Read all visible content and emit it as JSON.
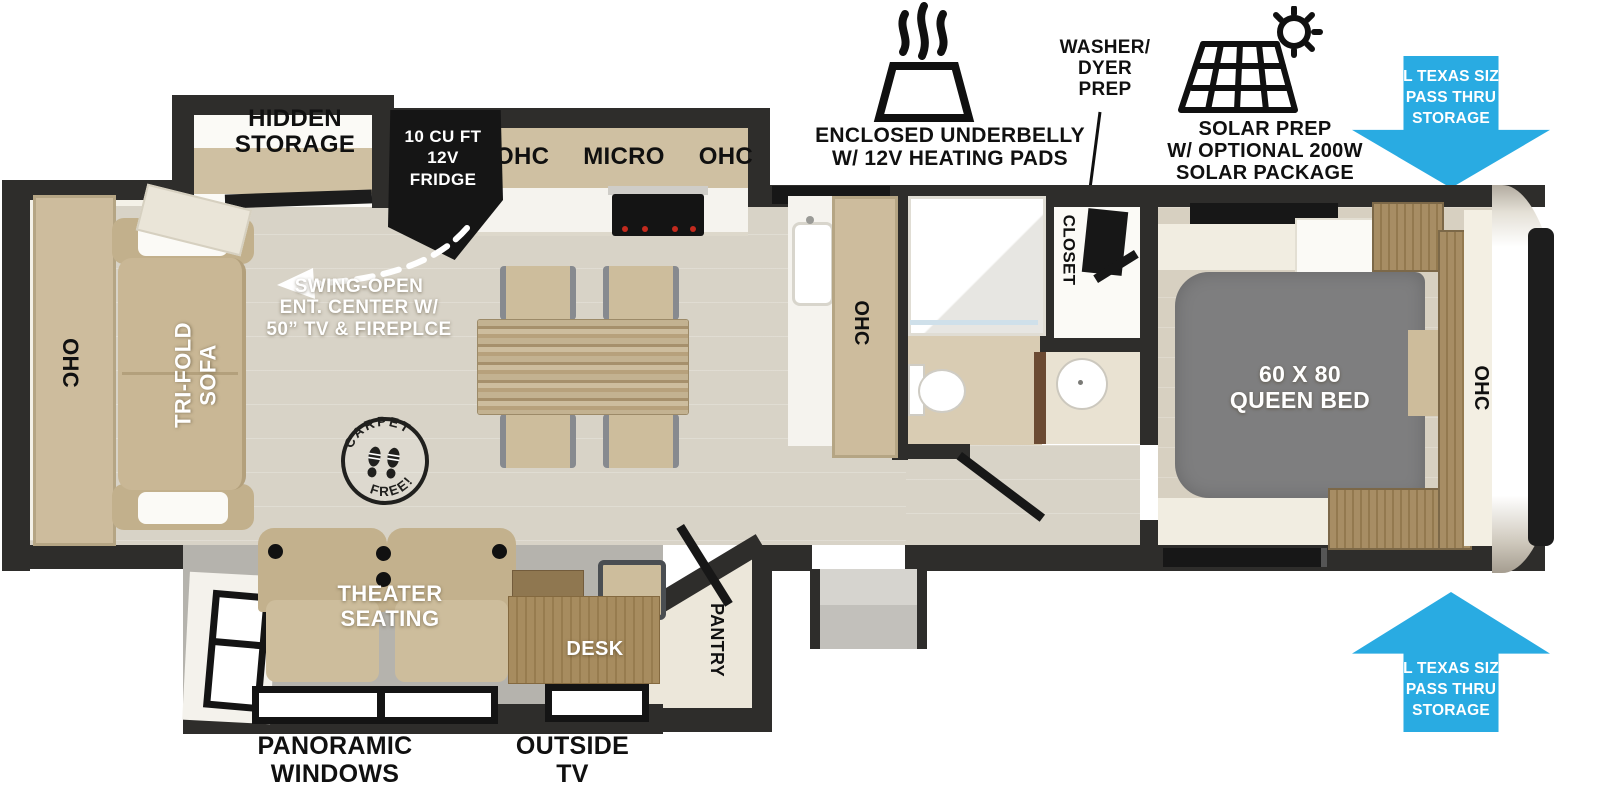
{
  "callouts": {
    "underbelly": {
      "icon": "heating-pad-icon",
      "lines": [
        "ENCLOSED UNDERBELLY",
        "W/ 12V HEATING PADS"
      ]
    },
    "washer_dryer": {
      "lines": [
        "WASHER/",
        "DYER",
        "PREP"
      ]
    },
    "solar": {
      "icon": "solar-panel-sun-icon",
      "lines": [
        "SOLAR PREP",
        "W/ OPTIONAL 200W",
        "SOLAR PACKAGE"
      ]
    },
    "pass_thru_top": {
      "icon": "blue-arrow-down-icon",
      "lines": [
        "XL TEXAS SIZE",
        "PASS THRU",
        "STORAGE"
      ]
    },
    "pass_thru_bottom": {
      "icon": "blue-arrow-up-icon",
      "lines": [
        "XL TEXAS SIZE",
        "PASS THRU",
        "STORAGE"
      ]
    }
  },
  "interior": {
    "hidden_storage": [
      "HIDDEN",
      "STORAGE"
    ],
    "fridge": [
      "10 CU FT",
      "12V",
      "FRIDGE"
    ],
    "kitchen_overhead": [
      "OHC",
      "MICRO",
      "OHC"
    ],
    "ent_center": [
      "SWING-OPEN",
      "ENT. CENTER W/",
      "50” TV & FIREPLCE"
    ],
    "carpet_stamp": {
      "top": "CARPET",
      "bottom": "FREE!"
    },
    "ohc_rear": "OHC",
    "sofa": [
      "TRI-FOLD",
      "SOFA"
    ],
    "ohc_kitchen": "OHC",
    "closet": "CLOSET",
    "queen_bed": [
      "60 X 80",
      "QUEEN BED"
    ],
    "ohc_bedroom": "OHC",
    "theater_seating": [
      "THEATER",
      "SEATING"
    ],
    "desk": "DESK",
    "pantry": "PANTRY"
  },
  "exterior_labels": {
    "panoramic_windows": [
      "PANORAMIC",
      "WINDOWS"
    ],
    "outside_tv": [
      "OUTSIDE",
      "TV"
    ]
  },
  "colors": {
    "accent_blue": "#29ABE2",
    "wall_dark": "#2E2D2B",
    "cabinet_tan": "#CDBC9D",
    "bed_gray": "#7E7E7F",
    "appliance_black": "#151515",
    "slide_floor_gray": "#B5B3AD"
  }
}
